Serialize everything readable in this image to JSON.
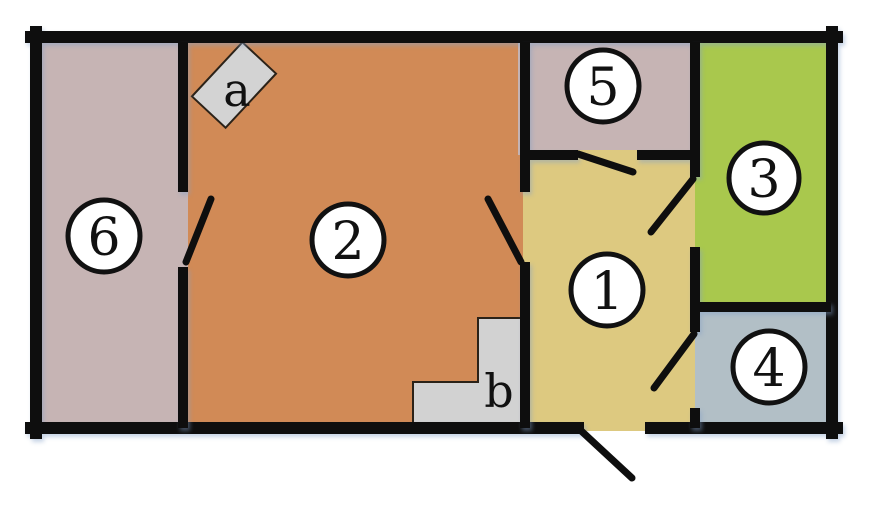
{
  "diagram": {
    "type": "floor-plan",
    "description": "Apartment floor plan with six numbered rooms, a rotated square marker 'a', a staircase 'b', and door swing arcs",
    "background": "#ffffff"
  },
  "colors": {
    "wall": "#0e0e0e",
    "door_leaf": "#0e0e0e",
    "room1_fill": "#ddc980",
    "room2_fill": "#d18a56",
    "room3_fill": "#a9c84d",
    "room4_fill": "#b2bfc6",
    "room5_fill": "#c6b4b4",
    "room6_fill": "#c6b4b4",
    "stairs_fill": "#d2d2d2",
    "stairs_outline": "#2b2218",
    "marker_fill": "#d3d3d3",
    "marker_outline": "#2b2218",
    "label_circle_fill": "#ffffff",
    "label_circle_stroke": "#111111",
    "label_text": "#111111"
  },
  "rooms": [
    {
      "id": "room-1",
      "label": "1"
    },
    {
      "id": "room-2",
      "label": "2"
    },
    {
      "id": "room-3",
      "label": "3"
    },
    {
      "id": "room-4",
      "label": "4"
    },
    {
      "id": "room-5",
      "label": "5"
    },
    {
      "id": "room-6",
      "label": "6"
    }
  ],
  "features": [
    {
      "id": "feature-a",
      "label": "a",
      "type": "rotated-square-marker"
    },
    {
      "id": "feature-b",
      "label": "b",
      "type": "stairs"
    }
  ]
}
